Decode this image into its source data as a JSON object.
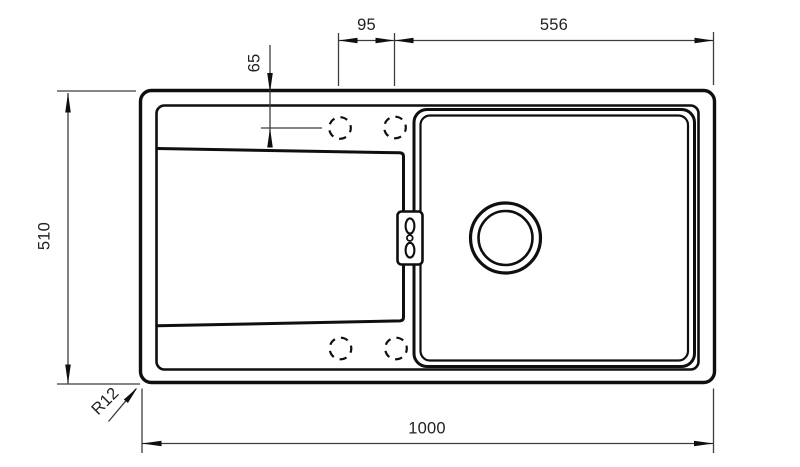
{
  "drawing": {
    "type": "technical-drawing",
    "subject": "Kitchen sink top view with left drainboard, right bowl, drain and faucet mounting holes",
    "units": "mm",
    "colors": {
      "background": "#ffffff",
      "object_line": "#0f0f0f",
      "dimension_line": "#3d3d3d",
      "text": "#222222"
    },
    "labels": {
      "hole_spacing": "95",
      "bowl_section_width": "556",
      "hole_center_offset": "65",
      "overall_depth": "510",
      "overall_width": "1000",
      "corner_radius": "R12"
    }
  }
}
